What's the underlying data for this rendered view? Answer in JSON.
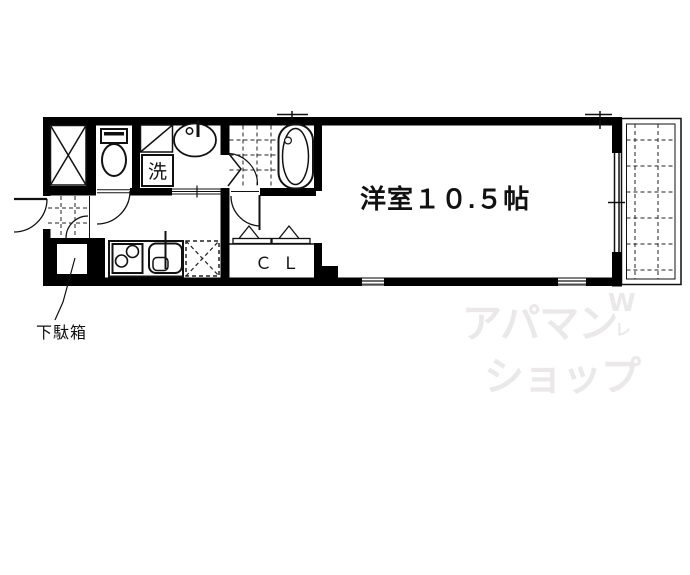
{
  "floorplan": {
    "main_room": {
      "label": "洋室１０.５帖"
    },
    "closet": {
      "label": "ＣＬ"
    },
    "washing_machine": {
      "label": "洗"
    },
    "shoe_cabinet": {
      "label": "下駄箱"
    },
    "watermark": {
      "line1": "アパマン",
      "line2": "ショップ",
      "mark": "W",
      "tick": "レ",
      "color": "#eae8e8"
    },
    "colors": {
      "wall": "#000000",
      "background": "#ffffff",
      "line": "#111111"
    }
  }
}
